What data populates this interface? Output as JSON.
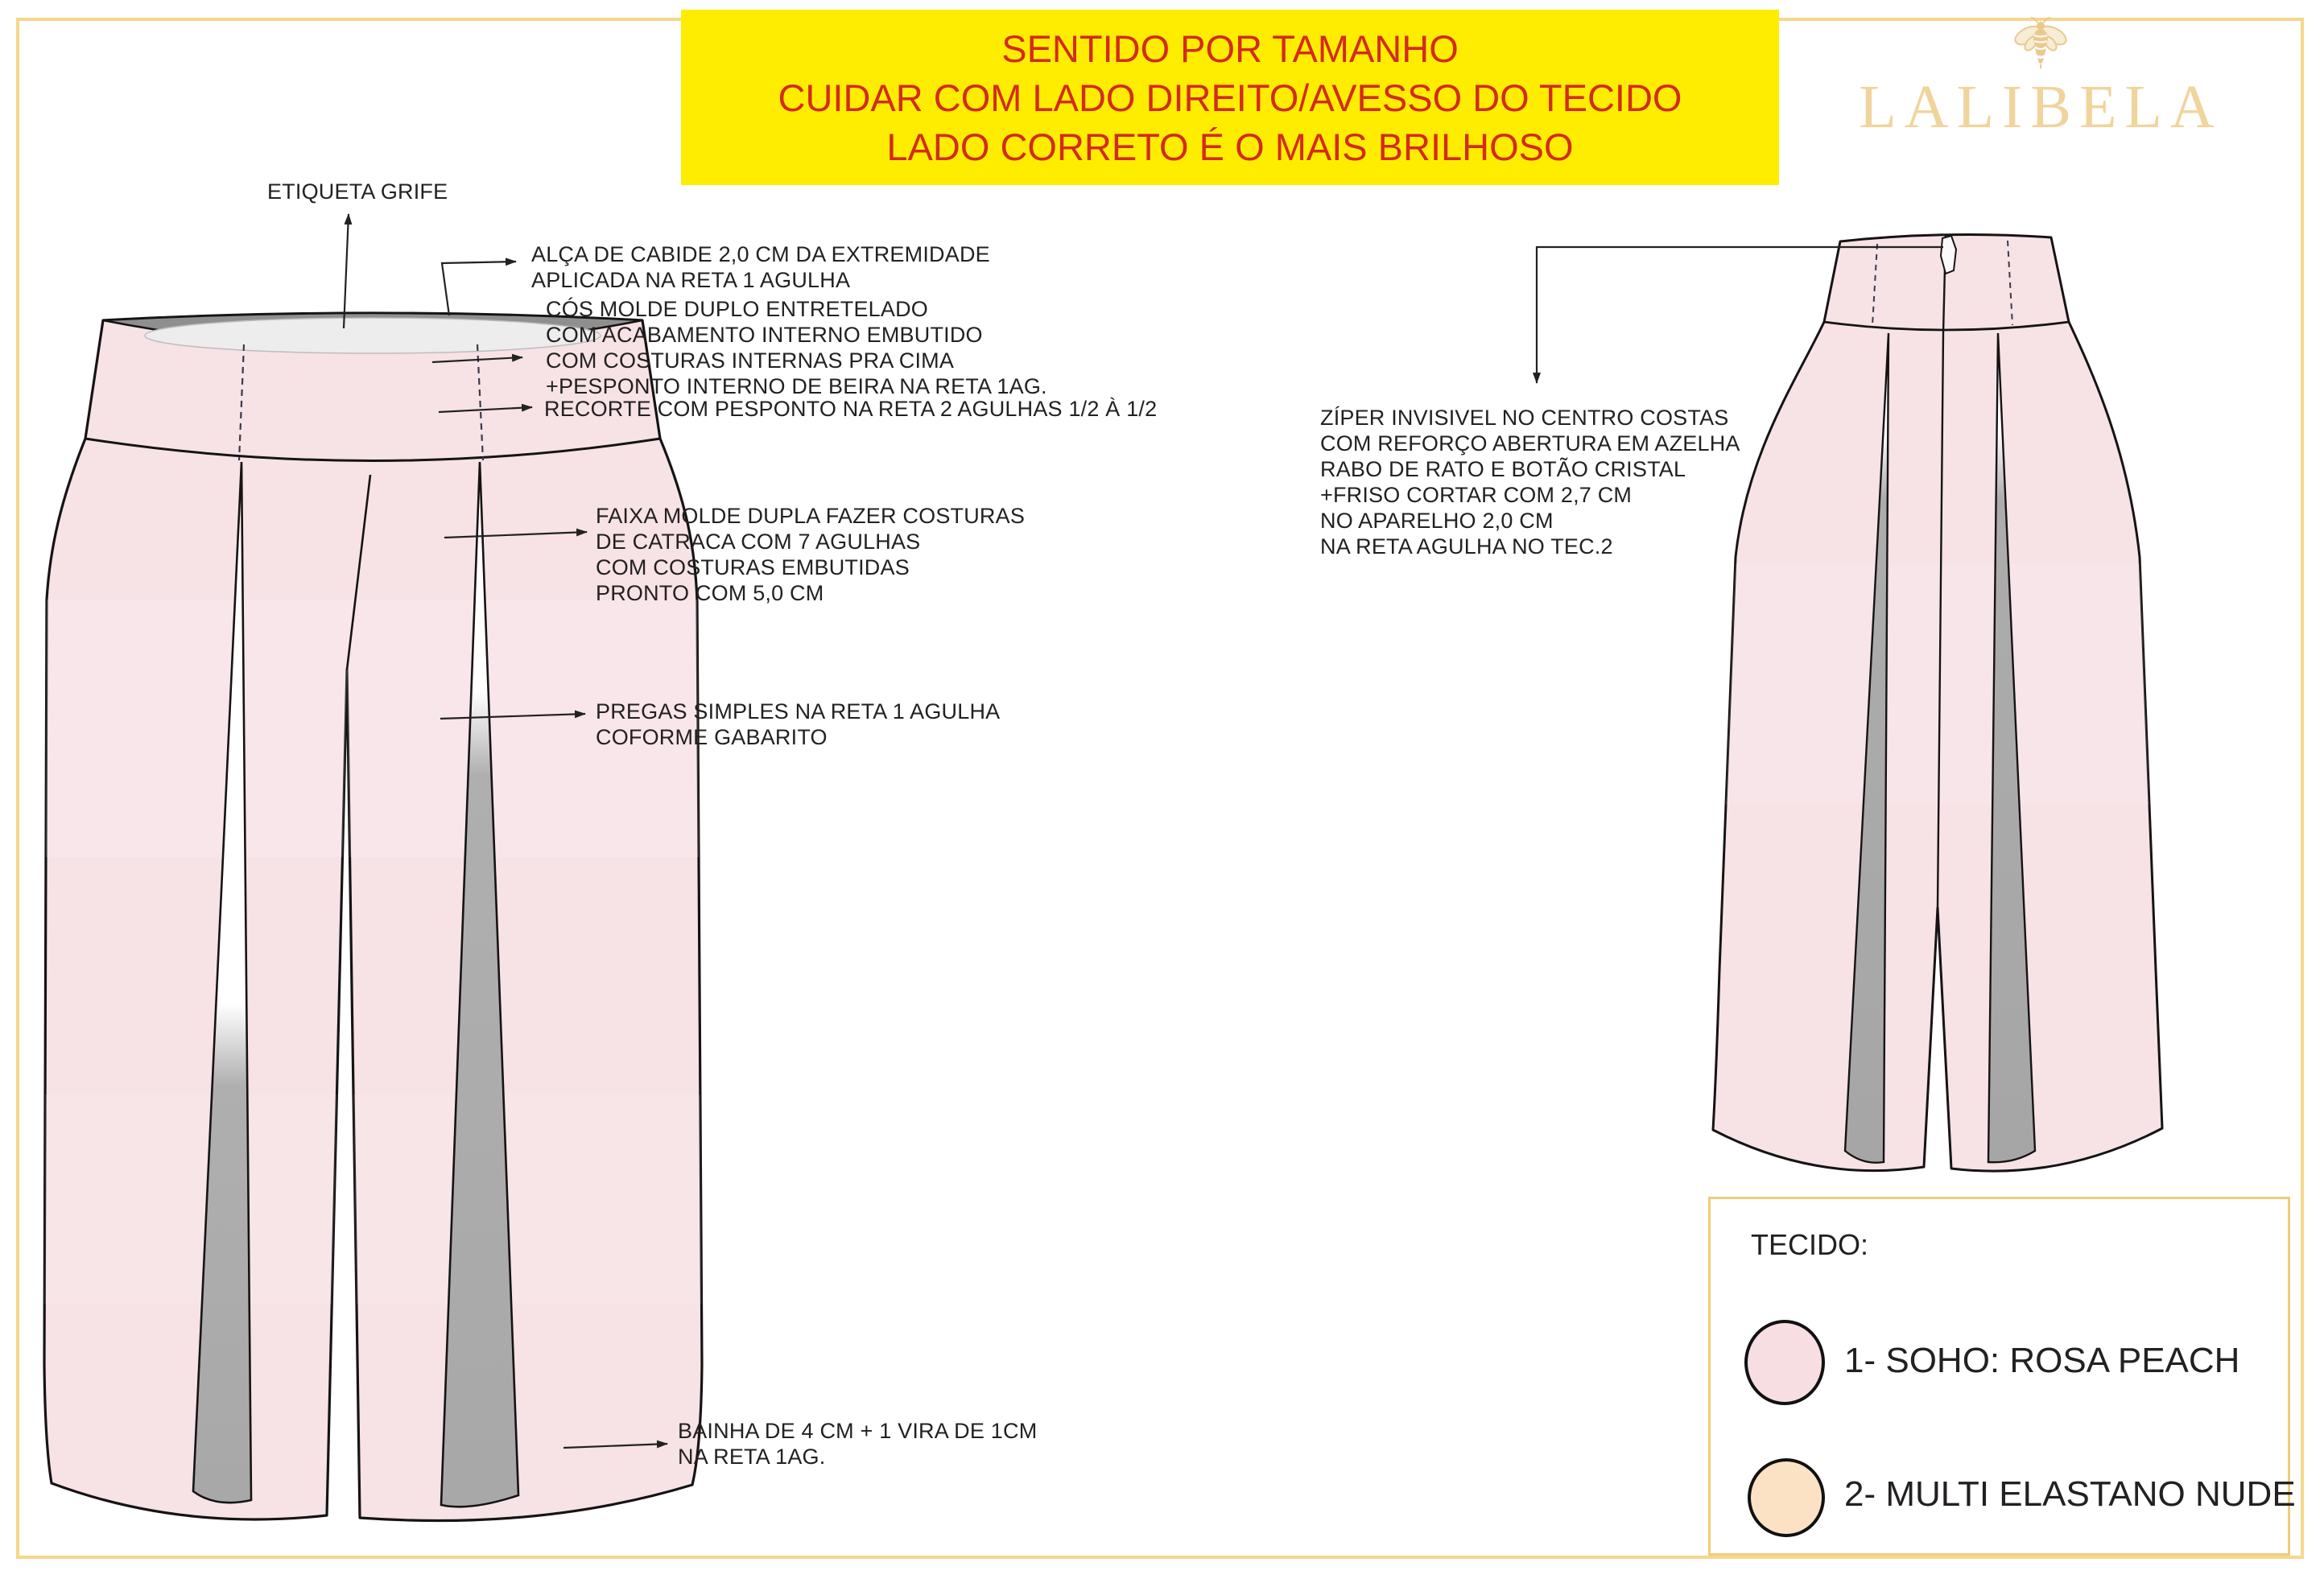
{
  "banner": {
    "lines": [
      "SENTIDO POR TAMANHO",
      "CUIDAR COM LADO DIREITO/AVESSO DO TECIDO",
      "LADO CORRETO É O MAIS BRILHOSO"
    ],
    "bg_color": "#FFED00",
    "text_color": "#D32B1E"
  },
  "logo": {
    "brand": "LALIBELA",
    "icon": "bee-icon",
    "color": "#F1D49B"
  },
  "annotations": {
    "etiqueta": "ETIQUETA GRIFE",
    "alca": "ALÇA DE CABIDE 2,0 CM DA EXTREMIDADE\nAPLICADA NA RETA 1 AGULHA",
    "cos": "CÓS MOLDE DUPLO ENTRETELADO\nCOM ACABAMENTO INTERNO EMBUTIDO\nCOM COSTURAS INTERNAS PRA CIMA\n+PESPONTO INTERNO DE BEIRA NA RETA 1AG.",
    "recorte": "RECORTE COM PESPONTO NA RETA 2 AGULHAS 1/2 À 1/2",
    "faixa": "FAIXA MOLDE DUPLA FAZER COSTURAS\nDE  CATRACA COM 7 AGULHAS\nCOM COSTURAS EMBUTIDAS\nPRONTO COM  5,0 CM",
    "pregas": "PREGAS SIMPLES NA RETA 1 AGULHA\nCOFORME GABARITO",
    "bainha": "BAINHA DE 4 CM + 1 VIRA DE 1CM\nNA RETA 1AG.",
    "ziper": "ZÍPER INVISIVEL NO CENTRO COSTAS\nCOM REFORÇO ABERTURA EM AZELHA\nRABO DE RATO E BOTÃO CRISTAL\n+FRISO CORTAR COM 2,7 CM\nNO APARELHO 2,0 CM\nNA RETA AGULHA NO TEC.2"
  },
  "legend": {
    "title": "TECIDO:",
    "items": [
      {
        "label": "1- SOHO: ROSA PEACH",
        "color": "#F6DEE3"
      },
      {
        "label": "2- MULTI ELASTANO NUDE",
        "color": "#FCE2C5"
      }
    ]
  },
  "colors": {
    "fabric_pink": "#F7E2E6",
    "pleat_gray": "#ACACAC",
    "frame_gold": "#F5D78C",
    "banner_yellow": "#FFED00",
    "banner_red": "#D32B1E",
    "logo_gold": "#F1D49B",
    "outline": "#141414"
  }
}
